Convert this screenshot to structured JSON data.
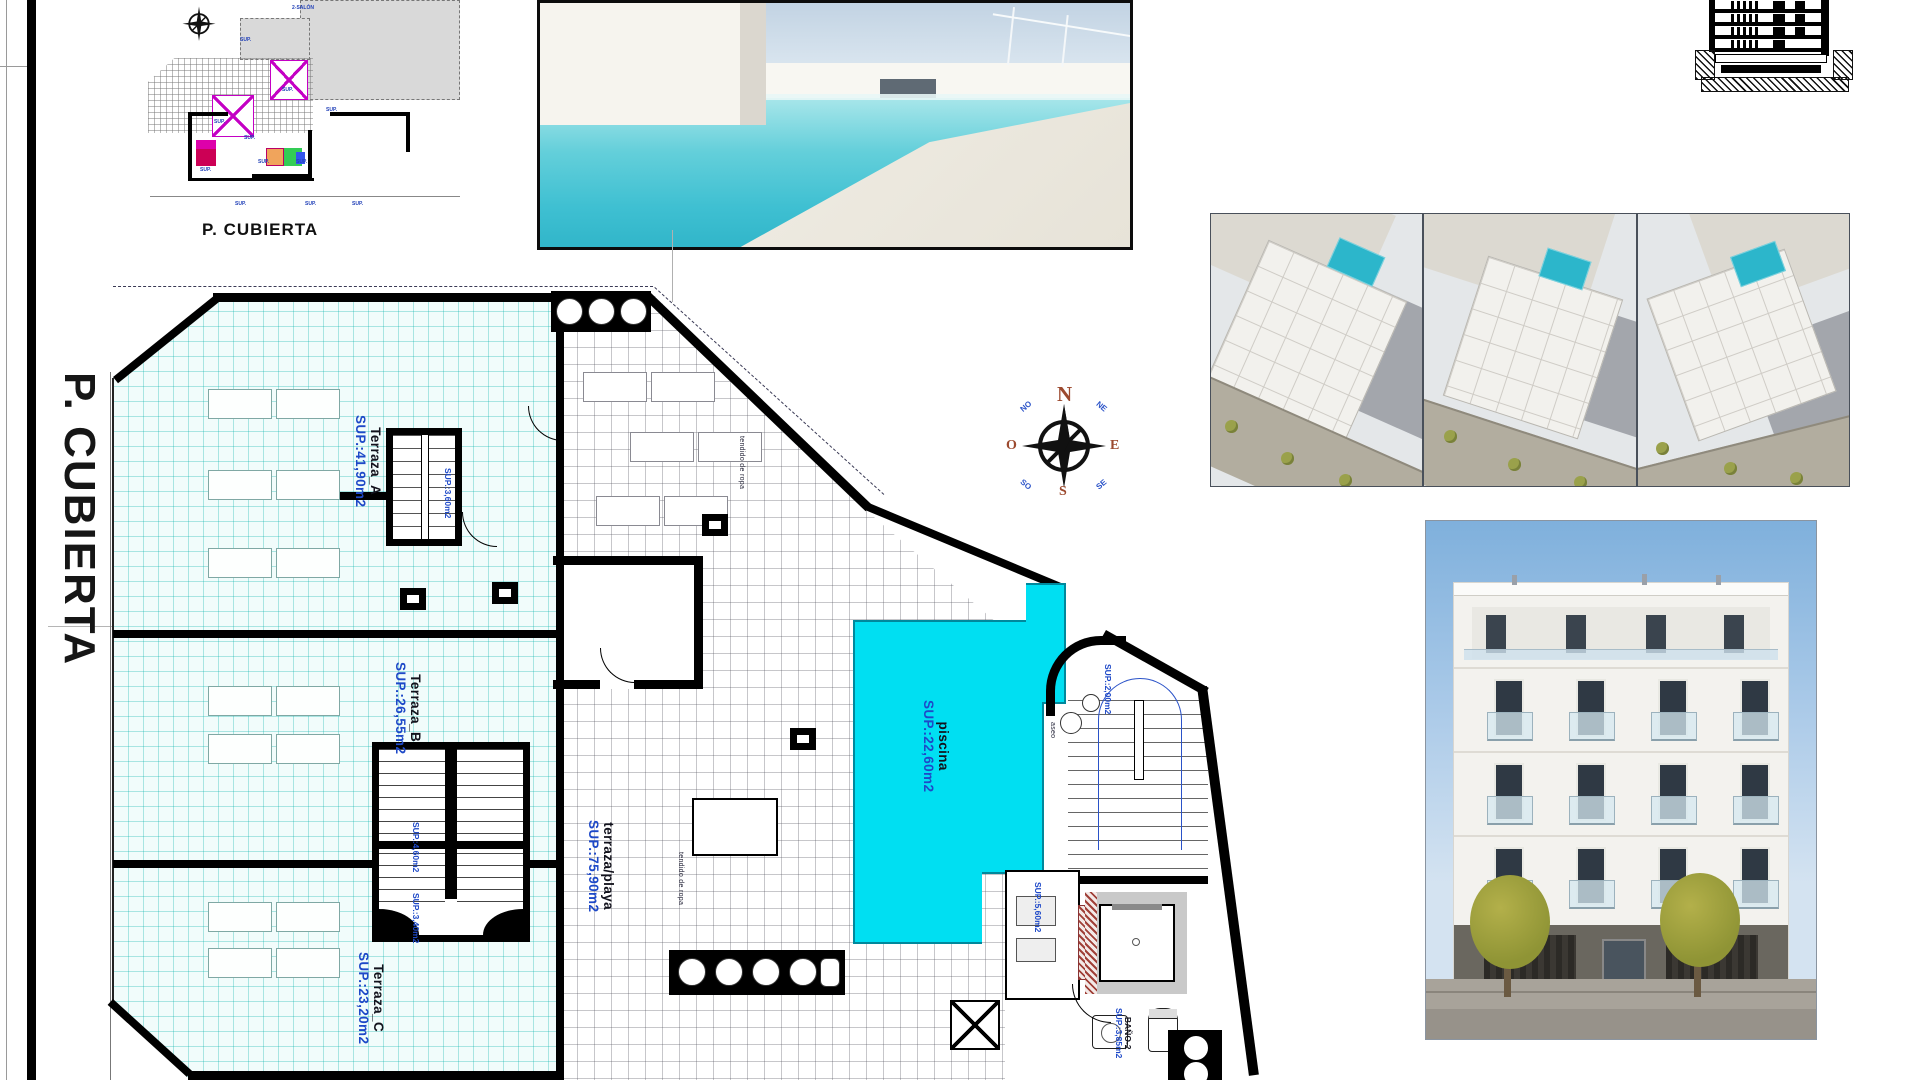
{
  "sheet": {
    "side_title": "P. CUBIERTA"
  },
  "mini_plan": {
    "caption": "P. CUBIERTA",
    "block_label": "2-SALÓN",
    "micro": "SUP."
  },
  "compass": {
    "n": "N",
    "e": "E",
    "s": "S",
    "o": "O",
    "ne": "NE",
    "se": "SE",
    "so": "SO",
    "no": "NO"
  },
  "plan": {
    "terraza_a": {
      "name": "Terraza_A",
      "area": "SUP.:41,90m2"
    },
    "terraza_b": {
      "name": "Terraza_B",
      "area": "SUP.:26,55m2"
    },
    "terraza_c": {
      "name": "Terraza_C",
      "area": "SUP.:23,20m2"
    },
    "playa": {
      "name": "terraza/playa",
      "area": "SUP.:75,90m2"
    },
    "piscina": {
      "name": "piscina",
      "area": "SUP.:22,60m2"
    },
    "stair_a_sup": "SUP.:3,60m2",
    "stair_b_sup": "SUP.:4,60m2",
    "stair_c_sup": "SUP.:3,40m2",
    "stair_r_sup": "SUP.:2,00m2",
    "plant_sup": "SUP.:5,60m2",
    "bano": {
      "name": "BAÑO-2",
      "area": "SUP.:3,85m2"
    },
    "aseo": "aseo",
    "tendido": "tendido de ropa"
  }
}
